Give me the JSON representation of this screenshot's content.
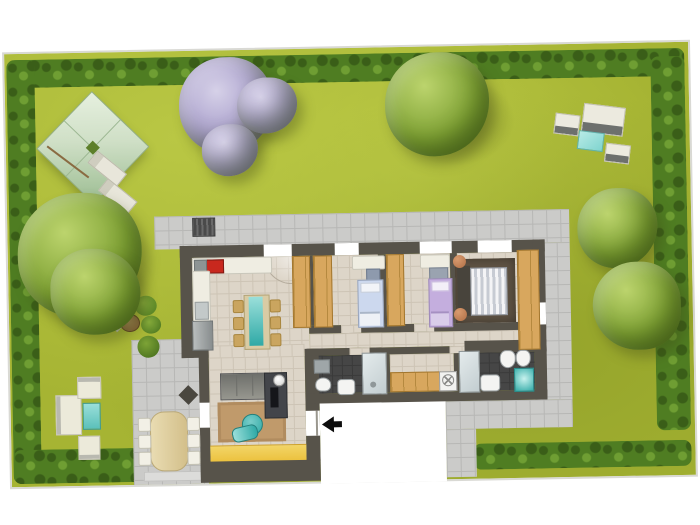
{
  "scene": {
    "kind": "residential-floor-plan-with-garden",
    "text_labels": [],
    "entrance": {
      "marker": "arrow-icon",
      "direction": "left"
    },
    "outdoor_elements": [
      "lawn",
      "hedge-border",
      "pavilion-canopy",
      "sun-loungers",
      "blossom-tree",
      "green-trees",
      "garden-sofa-set",
      "garden-bench-set",
      "wicker-chairs-with-table",
      "paved-patio",
      "paved-path",
      "outdoor-dining-table"
    ],
    "rooms": [
      "kitchen-dining",
      "living-room",
      "bedroom-1",
      "bedroom-2",
      "master-bedroom",
      "bathroom-1",
      "bathroom-2",
      "hallway-laundry"
    ],
    "furniture": [
      "kitchen-counter",
      "cooktop",
      "sink",
      "fridge",
      "dining-table",
      "wardrobes",
      "single-bed-blue",
      "single-bed-purple",
      "double-bed",
      "sofa",
      "tv-unit",
      "rug",
      "lounge-chair",
      "washing-machine",
      "toilet",
      "bidet",
      "washbasin",
      "shower",
      "coffee-table"
    ]
  },
  "colors": {
    "lawn": "#a6b433",
    "lawn_light": "#b9c744",
    "lawn_dark": "#95a42b",
    "hedge": "#4f7d22",
    "hedge_dark": "#3a5e18",
    "hedge_light": "#6f9e33",
    "tree": "#7fa234",
    "tree_light": "#bcd46d",
    "tree_dark": "#55761f",
    "blossom": "#a89ecb",
    "blossom_light": "#d6d1e8",
    "blossom_dark": "#857aa9",
    "pavilion": "#cfdfc6",
    "pavilion_dark": "#9cbd92",
    "wall": "#57534a",
    "floor": "#ddd5c8",
    "floor_line": "#cdc4b5",
    "tile": "#cbcbc9",
    "tile_line": "#b7b7b5",
    "dark_floor": "#464646",
    "dark_floor_line": "#3a3a3a",
    "wood": "#d8a75e",
    "wood_line": "#b5893f",
    "teal": "#2fa9a6",
    "teal_light": "#9adfda",
    "yellow": "#ecc23f",
    "rug": "#c09a6b",
    "rug_master": "#5e5243",
    "sofa": "#97978f",
    "sofa_dark": "#43454a",
    "bed_blue": "#ccd8ee",
    "bed_purple": "#c4aede",
    "bed_white": "#e9e9ec",
    "white_furn": "#efede2",
    "chair": "#caa55f",
    "copper": "#b06f46",
    "stove": "#c8281e",
    "arrow": "#0d0d0d",
    "boundary": "#d9d9d4"
  }
}
